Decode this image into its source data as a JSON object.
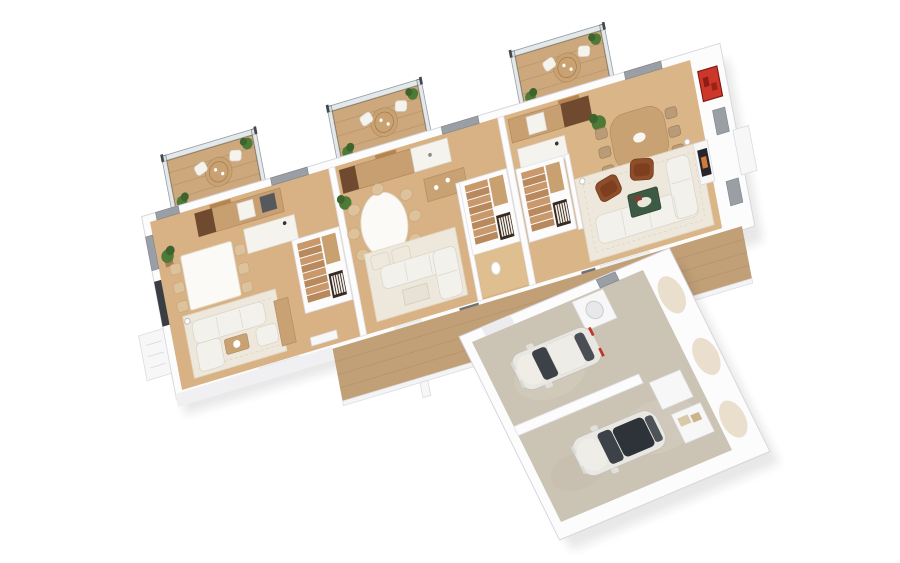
{
  "scene": {
    "title": "3D floor plan aerial render",
    "description": "Aerial 3D cutaway floor plan of a three-unit residence with rear balconies and an attached two-car garage",
    "units_count": 3,
    "balconies_count": 3,
    "staircases_count": 3,
    "cars_count": 2
  },
  "inventory": {
    "balcony": [
      "glass-railing",
      "round-wood-table",
      "lounge-chairs",
      "potted-plants"
    ],
    "left_unit": [
      "kitchen-counter",
      "fridge",
      "kitchen-island",
      "dining-table",
      "dining-chairs",
      "staircase",
      "book-shelf",
      "rug",
      "sofa-set",
      "coffee-table",
      "sideboard",
      "plant"
    ],
    "middle_unit": [
      "kitchen-counter",
      "oval-dining-table",
      "dining-chairs",
      "buffet",
      "ottomans",
      "rug",
      "l-sofa",
      "sofa-table",
      "staircase",
      "book-shelf",
      "toilet",
      "plant"
    ],
    "right_unit": [
      "kitchen-counter",
      "kitchen-island",
      "wood-dining-table",
      "dining-chairs",
      "red-wall-art",
      "staircase",
      "book-shelf",
      "rug",
      "sectional-sofa",
      "leather-armchairs",
      "green-coffee-table",
      "fireplace",
      "floor-lamps",
      "plant"
    ],
    "garage": [
      "concrete-floor",
      "divider-wall",
      "hatchback-car",
      "sedan-car",
      "storage-cabinets",
      "utility-box",
      "wall-niches"
    ],
    "exterior": [
      "wood-deck",
      "deck-brackets",
      "gray-windows",
      "dark-window",
      "entry-stoop",
      "chimney-box",
      "vents"
    ]
  },
  "colors": {
    "background": "#ffffff",
    "wall_white": "#fcfcfd",
    "wall_stroke": "#d5d5dc",
    "wall_shadow": "#e2e2e8",
    "wood_floor": "#d8b285",
    "deck_wood": "#c19f77",
    "balcony_wood": "#cda87c",
    "concrete": "#cbc3b4",
    "counter_tan": "#c79f70",
    "island_white": "#f5f3ee",
    "sofa_white": "#f3f1ec",
    "rug_white": "#eee8dc",
    "leather_brown": "#8e4e2a",
    "coffee_table_green": "#3d5a45",
    "art_red": "#cc372a",
    "plant_green": "#4e7a38",
    "pot_brown": "#a97c58",
    "glass_rail": "#ccd8de",
    "rail_frame": "#4b5157",
    "window_gray": "#999fa5",
    "door_tan": "#b5854f",
    "shelf_dark": "#382a20",
    "car_body": "#e9e7e1",
    "car_glass": "#3d4249",
    "taillight_red": "#c23327"
  }
}
